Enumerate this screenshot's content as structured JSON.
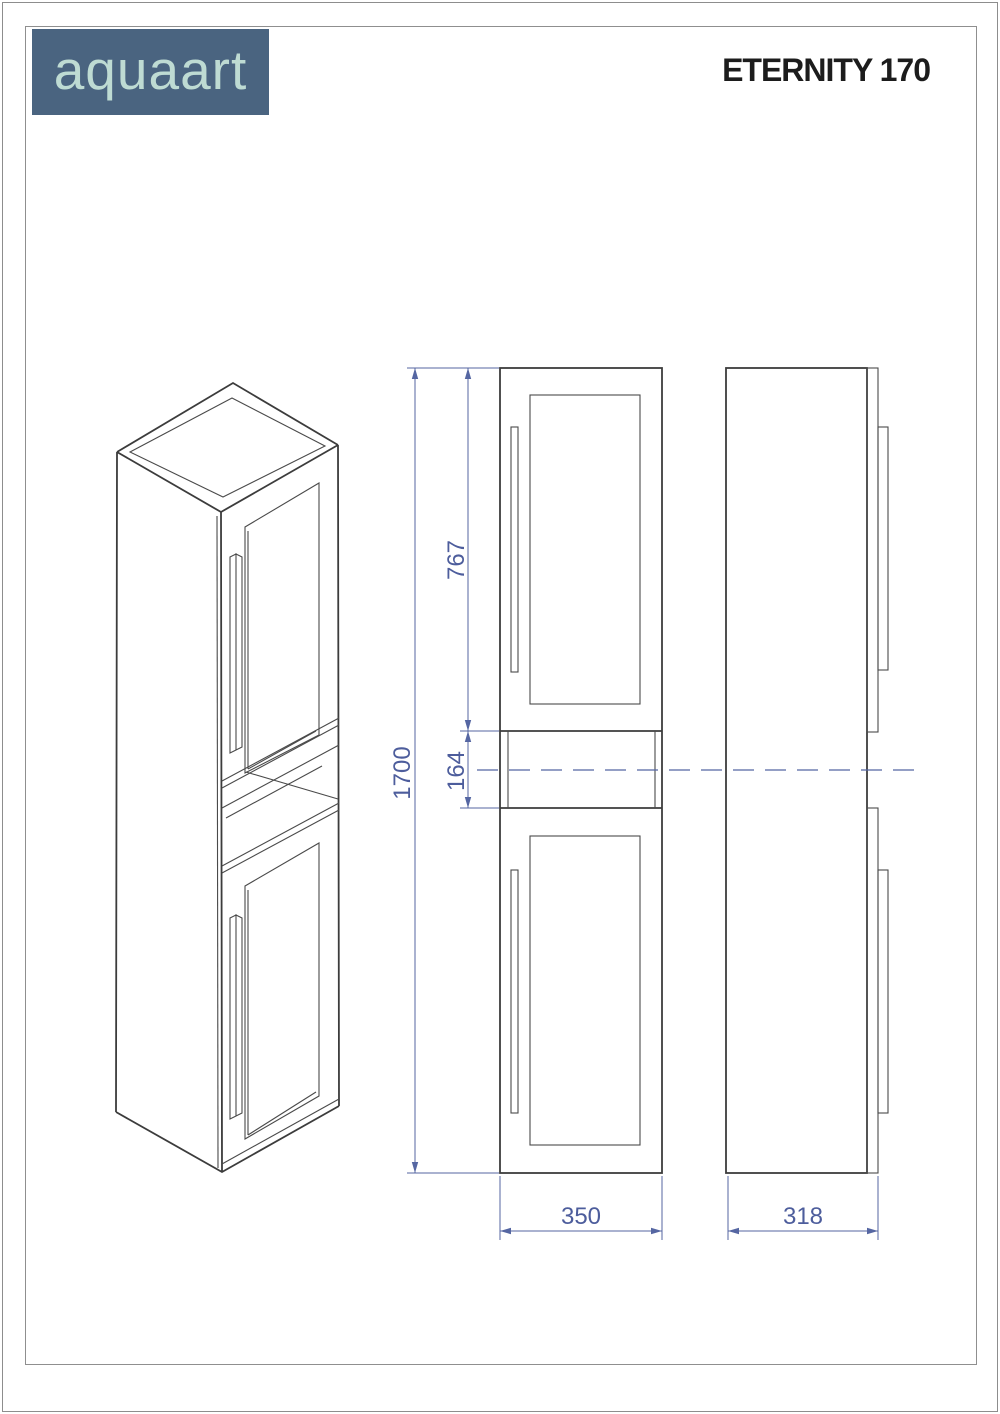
{
  "brand": {
    "name": "aquaart",
    "bg_color": "#4a6480",
    "text_color": "#bedbd3"
  },
  "product": {
    "title": "ETERNITY 170"
  },
  "dims": {
    "total_height": "1700",
    "upper_section_height": "767",
    "niche_height": "164",
    "width": "350",
    "depth": "318"
  },
  "drawing_colors": {
    "line": "#3c3c3c",
    "dimension": "#5566a2"
  }
}
